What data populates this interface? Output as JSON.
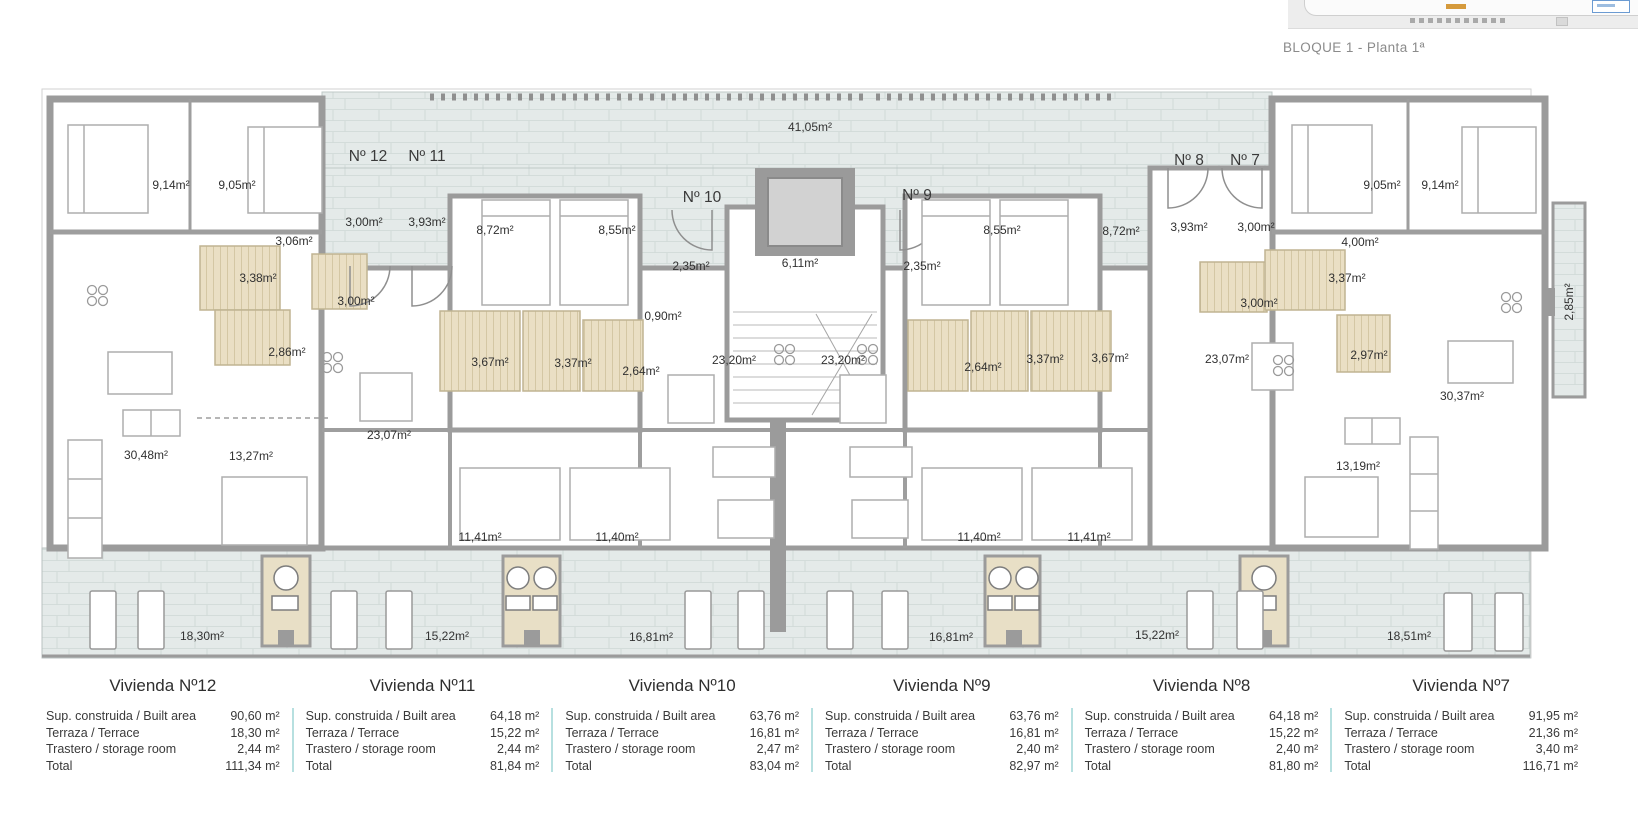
{
  "header": {
    "plan_title": "BLOQUE 1 - Planta 1ª"
  },
  "plan": {
    "unit_labels": [
      {
        "text": "Nº 12",
        "x": 368,
        "y": 157
      },
      {
        "text": "Nº 11",
        "x": 427,
        "y": 157
      },
      {
        "text": "Nº 10",
        "x": 702,
        "y": 198
      },
      {
        "text": "Nº 9",
        "x": 917,
        "y": 196
      },
      {
        "text": "Nº 8",
        "x": 1189,
        "y": 161
      },
      {
        "text": "Nº 7",
        "x": 1245,
        "y": 161
      }
    ],
    "area_labels": [
      {
        "text": "41,05m²",
        "x": 810,
        "y": 127
      },
      {
        "text": "9,14m²",
        "x": 171,
        "y": 185
      },
      {
        "text": "9,05m²",
        "x": 237,
        "y": 185
      },
      {
        "text": "3,00m²",
        "x": 364,
        "y": 222
      },
      {
        "text": "3,93m²",
        "x": 427,
        "y": 222
      },
      {
        "text": "3,06m²",
        "x": 294,
        "y": 241
      },
      {
        "text": "3,38m²",
        "x": 258,
        "y": 278
      },
      {
        "text": "3,00m²",
        "x": 356,
        "y": 301
      },
      {
        "text": "2,86m²",
        "x": 287,
        "y": 352
      },
      {
        "text": "30,48m²",
        "x": 146,
        "y": 455
      },
      {
        "text": "13,27m²",
        "x": 251,
        "y": 456
      },
      {
        "text": "23,07m²",
        "x": 389,
        "y": 435
      },
      {
        "text": "8,72m²",
        "x": 495,
        "y": 230
      },
      {
        "text": "8,55m²",
        "x": 617,
        "y": 230
      },
      {
        "text": "2,35m²",
        "x": 691,
        "y": 266
      },
      {
        "text": "6,11m²",
        "x": 800,
        "y": 263
      },
      {
        "text": "2,35m²",
        "x": 922,
        "y": 266
      },
      {
        "text": "0,90m²",
        "x": 663,
        "y": 316
      },
      {
        "text": "3,67m²",
        "x": 490,
        "y": 362
      },
      {
        "text": "3,37m²",
        "x": 573,
        "y": 363
      },
      {
        "text": "2,64m²",
        "x": 641,
        "y": 371
      },
      {
        "text": "23,20m²",
        "x": 734,
        "y": 360
      },
      {
        "text": "23,20m²",
        "x": 843,
        "y": 360
      },
      {
        "text": "2,64m²",
        "x": 983,
        "y": 367
      },
      {
        "text": "3,37m²",
        "x": 1045,
        "y": 359
      },
      {
        "text": "3,67m²",
        "x": 1110,
        "y": 358
      },
      {
        "text": "8,55m²",
        "x": 1002,
        "y": 230
      },
      {
        "text": "8,72m²",
        "x": 1121,
        "y": 231
      },
      {
        "text": "11,41m²",
        "x": 480,
        "y": 537
      },
      {
        "text": "11,40m²",
        "x": 617,
        "y": 537
      },
      {
        "text": "11,40m²",
        "x": 979,
        "y": 537
      },
      {
        "text": "11,41m²",
        "x": 1089,
        "y": 537
      },
      {
        "text": "3,93m²",
        "x": 1189,
        "y": 227
      },
      {
        "text": "3,00m²",
        "x": 1256,
        "y": 227
      },
      {
        "text": "4,00m²",
        "x": 1360,
        "y": 242
      },
      {
        "text": "9,05m²",
        "x": 1382,
        "y": 185
      },
      {
        "text": "9,14m²",
        "x": 1440,
        "y": 185
      },
      {
        "text": "3,00m²",
        "x": 1259,
        "y": 303
      },
      {
        "text": "3,37m²",
        "x": 1347,
        "y": 278
      },
      {
        "text": "2,97m²",
        "x": 1369,
        "y": 355
      },
      {
        "text": "23,07m²",
        "x": 1227,
        "y": 359
      },
      {
        "text": "30,37m²",
        "x": 1462,
        "y": 396
      },
      {
        "text": "13,19m²",
        "x": 1358,
        "y": 466
      },
      {
        "text": "2,85m²",
        "x": 1569,
        "y": 302,
        "rot": true
      },
      {
        "text": "18,30m²",
        "x": 202,
        "y": 636
      },
      {
        "text": "15,22m²",
        "x": 447,
        "y": 636
      },
      {
        "text": "16,81m²",
        "x": 651,
        "y": 637
      },
      {
        "text": "16,81m²",
        "x": 951,
        "y": 637
      },
      {
        "text": "15,22m²",
        "x": 1157,
        "y": 635
      },
      {
        "text": "18,51m²",
        "x": 1409,
        "y": 636
      }
    ]
  },
  "tables": [
    {
      "title": "Vivienda Nº12",
      "rows": [
        {
          "label": "Sup. construida / Built area",
          "value": "90,60 m²"
        },
        {
          "label": "Terraza / Terrace",
          "value": "18,30 m²"
        },
        {
          "label": "Trastero / storage room",
          "value": "2,44 m²"
        },
        {
          "label": "Total",
          "value": "111,34 m²"
        }
      ]
    },
    {
      "title": "Vivienda Nº11",
      "rows": [
        {
          "label": "Sup. construida / Built area",
          "value": "64,18 m²"
        },
        {
          "label": "Terraza / Terrace",
          "value": "15,22 m²"
        },
        {
          "label": "Trastero / storage room",
          "value": "2,44 m²"
        },
        {
          "label": "Total",
          "value": "81,84 m²"
        }
      ]
    },
    {
      "title": "Vivienda Nº10",
      "rows": [
        {
          "label": "Sup. construida / Built area",
          "value": "63,76 m²"
        },
        {
          "label": "Terraza / Terrace",
          "value": "16,81 m²"
        },
        {
          "label": "Trastero / storage room",
          "value": "2,47 m²"
        },
        {
          "label": "Total",
          "value": "83,04 m²"
        }
      ]
    },
    {
      "title": "Vivienda Nº9",
      "rows": [
        {
          "label": "Sup. construida / Built area",
          "value": "63,76 m²"
        },
        {
          "label": "Terraza / Terrace",
          "value": "16,81 m²"
        },
        {
          "label": "Trastero / storage room",
          "value": "2,40 m²"
        },
        {
          "label": "Total",
          "value": "82,97 m²"
        }
      ]
    },
    {
      "title": "Vivienda Nº8",
      "rows": [
        {
          "label": "Sup. construida / Built area",
          "value": "64,18 m²"
        },
        {
          "label": "Terraza / Terrace",
          "value": "15,22 m²"
        },
        {
          "label": "Trastero / storage room",
          "value": "2,40 m²"
        },
        {
          "label": "Total",
          "value": "81,80 m²"
        }
      ]
    },
    {
      "title": "Vivienda Nº7",
      "rows": [
        {
          "label": "Sup. construida / Built area",
          "value": "91,95 m²"
        },
        {
          "label": "Terraza / Terrace",
          "value": "21,36 m²"
        },
        {
          "label": "Trastero / storage room",
          "value": "3,40 m²"
        },
        {
          "label": "Total",
          "value": "116,71 m²"
        }
      ]
    }
  ],
  "colors": {
    "wall": "#9b9b9b",
    "tile": "#e4eae9",
    "tile_line": "#ccd6d4",
    "bath": "#eadfc4",
    "divider_teal": "#b7e0e0",
    "text": "#313131",
    "caption": "#8b8b8b"
  }
}
